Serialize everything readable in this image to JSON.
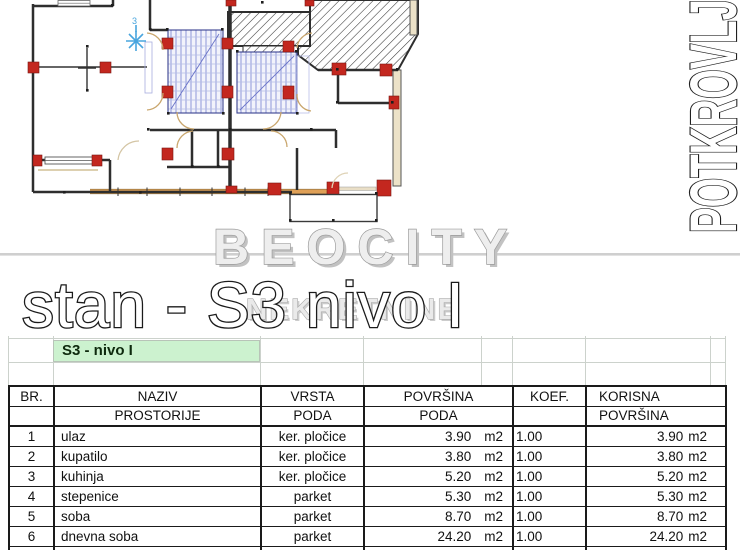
{
  "plan": {
    "vertical_label": "POTKROVLJ",
    "north_mark": "3"
  },
  "watermark": {
    "line1": "BEOCITY",
    "line2": "NEKRETNINE"
  },
  "title": "stan - S3 nivo I",
  "table": {
    "section_label": "S3 - nivo I",
    "columns": [
      {
        "line1": "BR.",
        "line2": ""
      },
      {
        "line1": "NAZIV",
        "line2": "PROSTORIJE"
      },
      {
        "line1": "VRSTA",
        "line2": "PODA"
      },
      {
        "line1": "POVRŠINA",
        "line2": "PODA"
      },
      {
        "line1": "KOEF.",
        "line2": ""
      },
      {
        "line1": "KORISNA",
        "line2": "POVRŠINA"
      }
    ],
    "unit": "m2",
    "rows": [
      {
        "br": "1",
        "naziv": "ulaz",
        "vrsta": "ker. pločice",
        "povrsina": "3.90",
        "koef": "1.00",
        "korisna": "3.90"
      },
      {
        "br": "2",
        "naziv": "kupatilo",
        "vrsta": "ker. pločice",
        "povrsina": "3.80",
        "koef": "1.00",
        "korisna": "3.80"
      },
      {
        "br": "3",
        "naziv": "kuhinja",
        "vrsta": "ker. pločice",
        "povrsina": "5.20",
        "koef": "1.00",
        "korisna": "5.20"
      },
      {
        "br": "4",
        "naziv": "stepenice",
        "vrsta": "parket",
        "povrsina": "5.30",
        "koef": "1.00",
        "korisna": "5.30"
      },
      {
        "br": "5",
        "naziv": "soba",
        "vrsta": "parket",
        "povrsina": "8.70",
        "koef": "1.00",
        "korisna": "8.70"
      },
      {
        "br": "6",
        "naziv": "dnevna soba",
        "vrsta": "parket",
        "povrsina": "24.20",
        "koef": "1.00",
        "korisna": "24.20"
      },
      {
        "br": "7",
        "naziv": "terasa",
        "vrsta": "ker. pločice",
        "povrsina": "4.60",
        "koef": "1.00",
        "korisna": "4.60"
      }
    ]
  },
  "colors": {
    "section-green": "#ccf2cf",
    "grid-faint": "#ccd2cc",
    "table-border": "#1a1a1a",
    "wall": "#2e2e2e",
    "marker-red": "#c3271f",
    "stair-blue": "#8d97d8",
    "window-orange": "#dfa057",
    "watermark-gray": "#c2c2c2",
    "divider-gray": "#cfcfcf"
  }
}
